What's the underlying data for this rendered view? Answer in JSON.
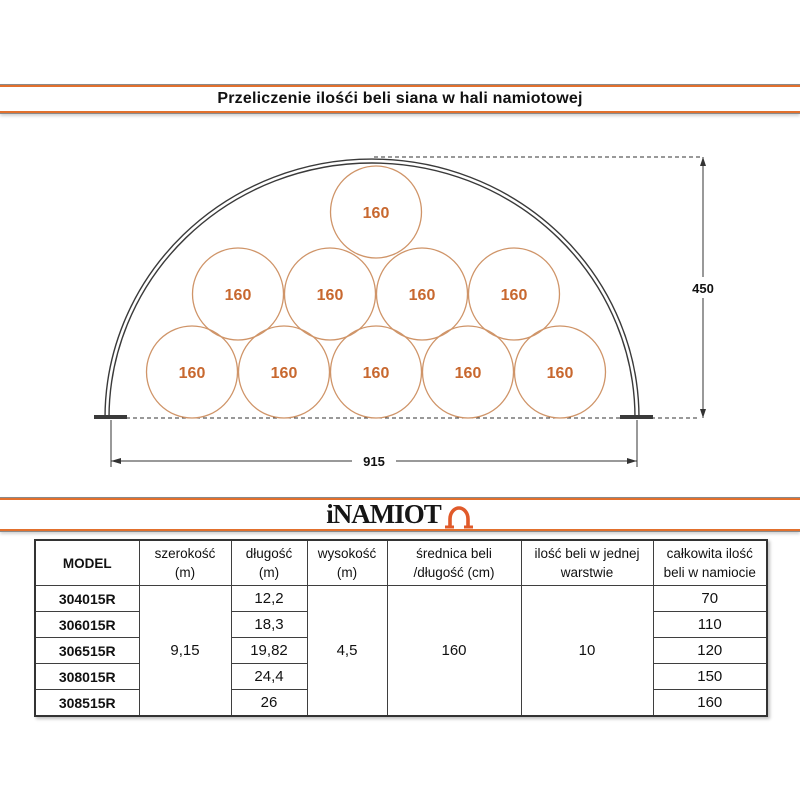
{
  "title": "Przeliczenie ilośći beli siana w hali namiotowej",
  "logo": {
    "text": "iNAMIOT",
    "accent_color": "#e2702d",
    "icon_color": "#e05a2a"
  },
  "diagram": {
    "bale_labels": [
      "160",
      "160",
      "160",
      "160",
      "160",
      "160",
      "160",
      "160",
      "160",
      "160"
    ],
    "height_label": "450",
    "width_label": "915"
  },
  "table": {
    "headers": [
      {
        "line1": "MODEL",
        "line2": ""
      },
      {
        "line1": "szerokość",
        "line2": "(m)"
      },
      {
        "line1": "długość",
        "line2": "(m)"
      },
      {
        "line1": "wysokość",
        "line2": "(m)"
      },
      {
        "line1": "średnica beli",
        "line2": "/długość (cm)"
      },
      {
        "line1": "ilość beli w jednej",
        "line2": "warstwie"
      },
      {
        "line1": "całkowita ilość",
        "line2": "beli w namiocie"
      }
    ],
    "merged": {
      "szerokosc": "9,15",
      "wysokosc": "4,5",
      "srednica": "160",
      "ilosc": "10"
    },
    "rows": [
      {
        "model": "304015R",
        "dlugosc": "12,2",
        "calkowita": "70"
      },
      {
        "model": "306015R",
        "dlugosc": "18,3",
        "calkowita": "110"
      },
      {
        "model": "306515R",
        "dlugosc": "19,82",
        "calkowita": "120"
      },
      {
        "model": "308015R",
        "dlugosc": "24,4",
        "calkowita": "150"
      },
      {
        "model": "308515R",
        "dlugosc": "26",
        "calkowita": "160"
      }
    ]
  },
  "colors": {
    "accent_orange": "#e2702d",
    "bale_stroke": "#cf9468",
    "bale_text": "#c8682f",
    "line_dark": "#3a3a3a"
  }
}
